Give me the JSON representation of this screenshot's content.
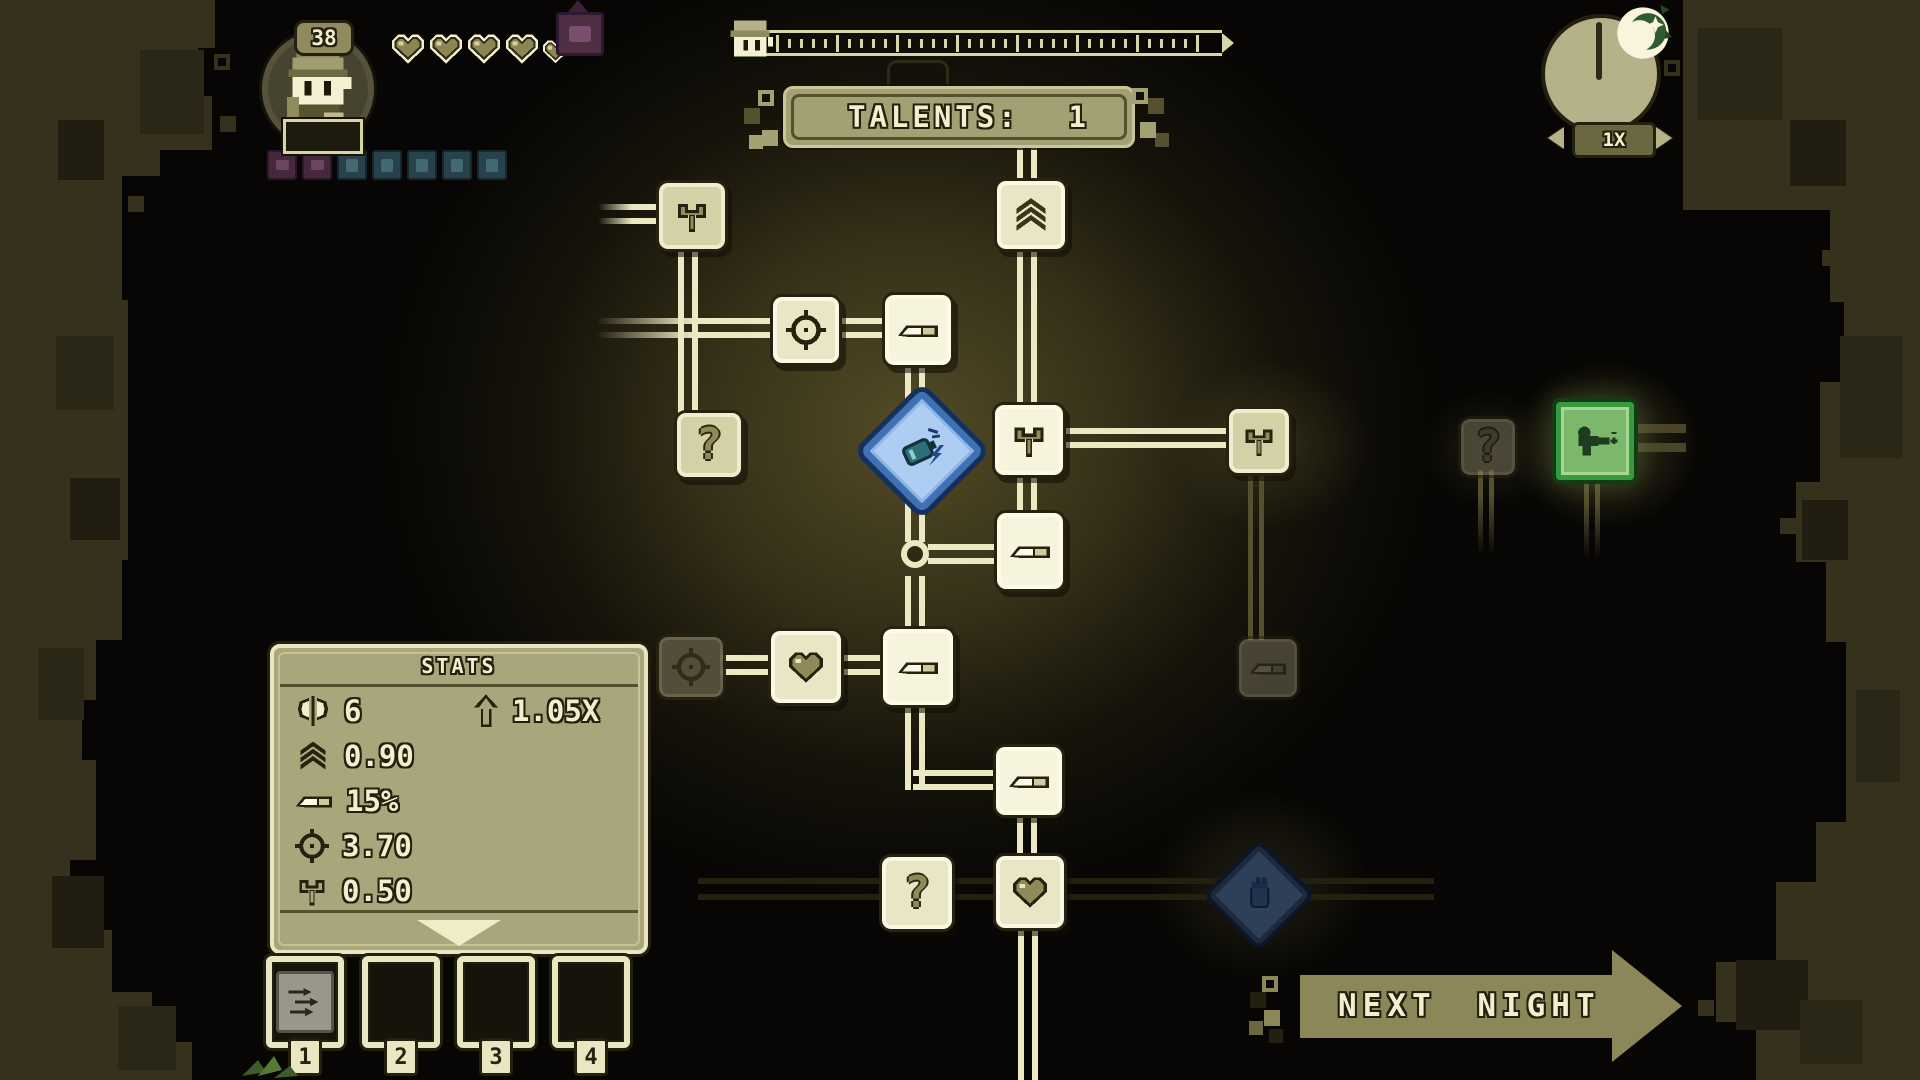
{
  "hud": {
    "level": "38",
    "hearts_full": 4,
    "hearts_small": 1,
    "status_squares": {
      "purple": 2,
      "teal": 5
    },
    "talents_label": "TALENTS:",
    "talents_value": "1",
    "speed": "1X",
    "progress_tick_count": 36
  },
  "stats": {
    "title": "STATS",
    "axe_value": "6",
    "multiplier_value": "1.05X",
    "chevrons_value": "0.90",
    "knife_value": "15%",
    "crosshair_value": "3.70",
    "hammer_value": "0.50"
  },
  "slots": {
    "labels": [
      "1",
      "2",
      "3",
      "4"
    ]
  },
  "buttons": {
    "next_night": "NEXT NIGHT"
  },
  "glyphs": {
    "question": "?"
  },
  "colors": {
    "cream": "#f2efce",
    "olive_wall": "#35311d",
    "accent_blue": "#3f72b4",
    "accent_green": "#7cb86c",
    "badge_purple": "#4e2f44",
    "badge_teal": "#28424c"
  }
}
